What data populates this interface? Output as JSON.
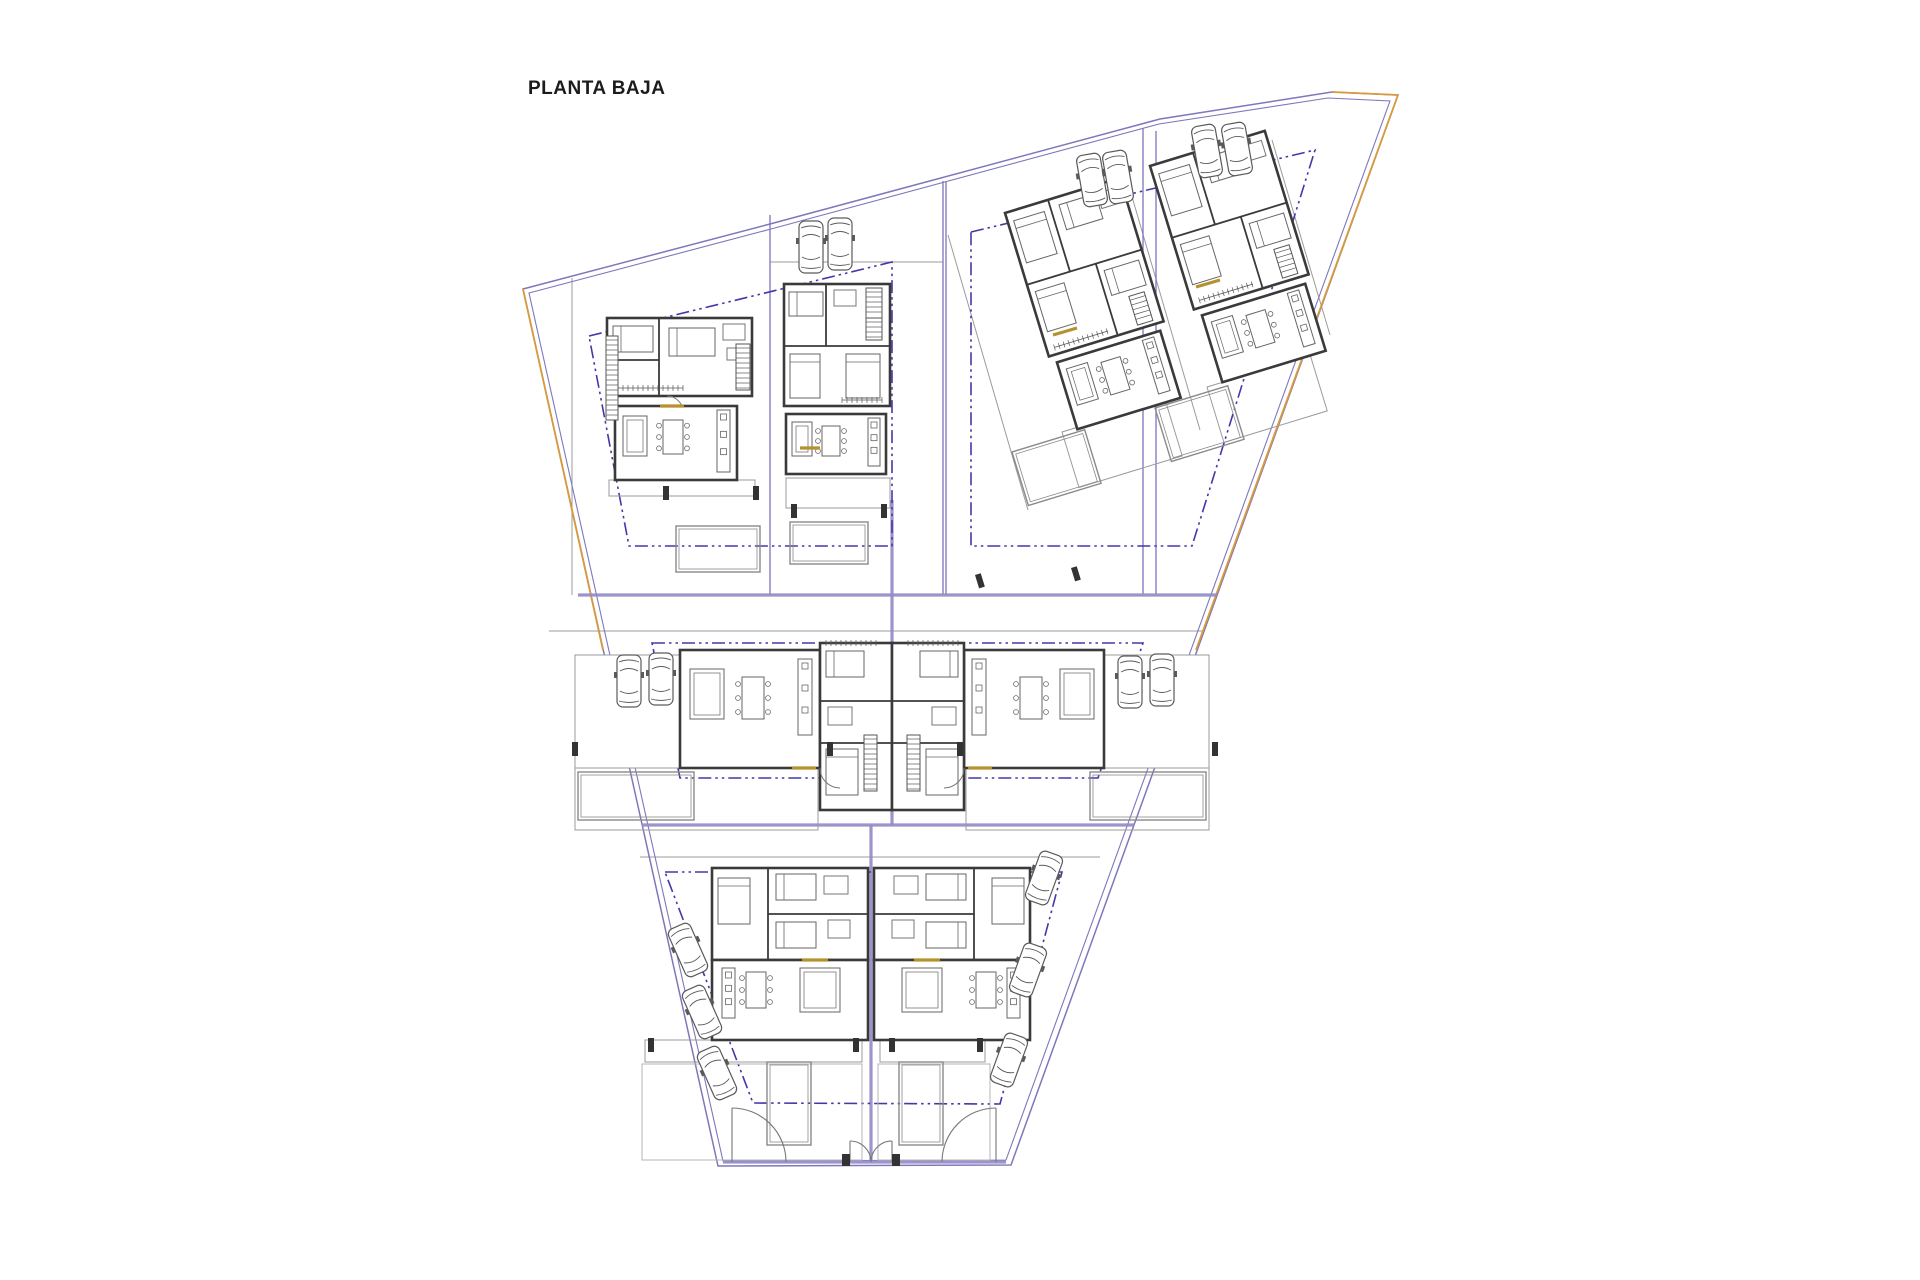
{
  "title": {
    "label": "PLANTA BAJA"
  },
  "colors": {
    "boundary_purple": "#7d77bc",
    "divider_lavender": "#918ac7",
    "setback_violet": "#4338a8",
    "site_orange": "#d79a3c",
    "wall_dark": "#3a3a3a",
    "furniture": "#666666",
    "thin_gray": "#9b9b9b",
    "garden_gray": "#b5b5b5",
    "gold_accent": "#b5922f",
    "car_gray": "#5a5a5a",
    "post_dark": "#333333"
  },
  "canvas": {
    "w": 1920,
    "h": 1280
  },
  "site": {
    "outer": "523,289 770,224 1160,119 1332,92 1398,95 1011,1165 718,1166",
    "inner": "529,293 771,229 1159,124 1328,98 1390,101 1006,1160 723,1161",
    "orange_segments": [
      [
        [
          523,
          289
        ],
        [
          603,
          650
        ]
      ],
      [
        [
          1332,
          92
        ],
        [
          1398,
          95
        ]
      ],
      [
        [
          1398,
          95
        ],
        [
          1196,
          650
        ]
      ]
    ]
  },
  "dividers_thick": [
    [
      578,
      595,
      1217,
      595
    ],
    [
      642,
      825,
      1134,
      825
    ],
    [
      892,
      500,
      892,
      825
    ],
    [
      871,
      825,
      871,
      1161
    ],
    [
      723,
      1162,
      1006,
      1162
    ]
  ],
  "dividers_thin_purple": [
    [
      770,
      215,
      770,
      595
    ],
    [
      943,
      181,
      943,
      595
    ],
    [
      946,
      182,
      946,
      595
    ],
    [
      1143,
      128,
      1143,
      594
    ],
    [
      1156,
      131,
      1156,
      594
    ]
  ],
  "thin_lines": [
    [
      572,
      278,
      572,
      595
    ],
    [
      770,
      262,
      943,
      262
    ],
    [
      549,
      631,
      1203,
      631
    ],
    [
      640,
      857,
      1100,
      857
    ],
    [
      948,
      235,
      1028,
      510
    ],
    [
      1128,
      183,
      1200,
      430
    ],
    [
      1272,
      140,
      1330,
      335
    ]
  ],
  "setbacks": [
    "589,336 892,262 892,546 629,546",
    "971,232 1315,150 1192,546 971,546",
    "652,643 1143,643 1098,778 680,778",
    "665,872 1062,872 1000,1104 753,1103"
  ],
  "terraces": [
    {
      "x": 609,
      "y": 480,
      "w": 146,
      "h": 16
    },
    {
      "x": 786,
      "y": 478,
      "w": 104,
      "h": 30
    },
    {
      "x": 575,
      "y": 768,
      "w": 243,
      "h": 62
    },
    {
      "x": 966,
      "y": 768,
      "w": 243,
      "h": 62
    },
    {
      "x": 645,
      "y": 1040,
      "w": 217,
      "h": 22
    },
    {
      "x": 880,
      "y": 1040,
      "w": 105,
      "h": 22
    },
    {
      "x": 1062,
      "y": 432,
      "w": 108,
      "h": 58,
      "rot": -17
    },
    {
      "x": 1207,
      "y": 387,
      "w": 108,
      "h": 58,
      "rot": -17
    }
  ],
  "pools": [
    {
      "x": 676,
      "y": 526,
      "w": 84,
      "h": 46
    },
    {
      "x": 790,
      "y": 522,
      "w": 78,
      "h": 42
    },
    {
      "x": 1012,
      "y": 452,
      "w": 76,
      "h": 56,
      "rot": -17
    },
    {
      "x": 1155,
      "y": 408,
      "w": 76,
      "h": 56,
      "rot": -17
    },
    {
      "x": 578,
      "y": 772,
      "w": 116,
      "h": 48
    },
    {
      "x": 1090,
      "y": 772,
      "w": 116,
      "h": 48
    },
    {
      "x": 767,
      "y": 1062,
      "w": 44,
      "h": 83
    },
    {
      "x": 899,
      "y": 1062,
      "w": 44,
      "h": 83
    }
  ],
  "gardens": [
    {
      "x": 642,
      "y": 1064,
      "w": 220,
      "h": 96
    },
    {
      "x": 878,
      "y": 1064,
      "w": 112,
      "h": 96
    }
  ],
  "templates": {
    "villa1": [
      {
        "t": "wall",
        "x": 0,
        "y": 0,
        "w": 145,
        "h": 78
      },
      {
        "t": "line",
        "x1": 52,
        "y1": 0,
        "x2": 52,
        "y2": 78
      },
      {
        "t": "line",
        "x1": 0,
        "y1": 42,
        "x2": 52,
        "y2": 42
      },
      {
        "t": "bedh",
        "x": 6,
        "y": 8,
        "w": 40,
        "h": 26
      },
      {
        "t": "bedh",
        "x": 62,
        "y": 10,
        "w": 46,
        "h": 28
      },
      {
        "t": "box",
        "x": 116,
        "y": 6,
        "w": 22,
        "h": 16
      },
      {
        "t": "box",
        "x": 120,
        "y": 30,
        "w": 12,
        "h": 12
      },
      {
        "t": "stair",
        "x": 129,
        "y": 26,
        "w": 14,
        "h": 46,
        "dir": "v"
      },
      {
        "t": "comb",
        "x": 6,
        "y": 70,
        "w": 70,
        "dir": "h"
      },
      {
        "t": "arc",
        "d": "M 60,78 a 16,16 0 0 1 16,16"
      },
      {
        "t": "wall",
        "x": 8,
        "y": 88,
        "w": 122,
        "h": 74
      },
      {
        "t": "sofa",
        "x": 16,
        "y": 98,
        "w": 24,
        "h": 40
      },
      {
        "t": "table",
        "x": 56,
        "y": 102,
        "w": 20,
        "h": 34
      },
      {
        "t": "kitchen",
        "x": 110,
        "y": 92,
        "w": 13,
        "h": 62
      }
    ],
    "villa2": [
      {
        "t": "wall",
        "x": 0,
        "y": 0,
        "w": 106,
        "h": 122
      },
      {
        "t": "line",
        "x1": 0,
        "y1": 62,
        "x2": 106,
        "y2": 62
      },
      {
        "t": "line",
        "x1": 42,
        "y1": 0,
        "x2": 42,
        "y2": 62
      },
      {
        "t": "bedh",
        "x": 5,
        "y": 8,
        "w": 34,
        "h": 24
      },
      {
        "t": "box",
        "x": 50,
        "y": 6,
        "w": 22,
        "h": 16
      },
      {
        "t": "bed",
        "x": 6,
        "y": 70,
        "w": 30,
        "h": 44
      },
      {
        "t": "bed",
        "x": 62,
        "y": 70,
        "w": 34,
        "h": 44
      },
      {
        "t": "stair",
        "x": 82,
        "y": 14,
        "w": 16,
        "h": 42,
        "dir": "v"
      },
      {
        "t": "comb",
        "x": 58,
        "y": 116,
        "w": 40,
        "dir": "h"
      },
      {
        "t": "wall",
        "x": 2,
        "y": 130,
        "w": 100,
        "h": 60
      },
      {
        "t": "sofa",
        "x": 8,
        "y": 138,
        "w": 20,
        "h": 34
      },
      {
        "t": "table",
        "x": 38,
        "y": 142,
        "w": 18,
        "h": 30
      },
      {
        "t": "kitchen",
        "x": 84,
        "y": 134,
        "w": 12,
        "h": 48
      }
    ],
    "villa3": [
      {
        "t": "wall",
        "x": 0,
        "y": 0,
        "w": 120,
        "h": 150
      },
      {
        "t": "line",
        "x1": 0,
        "y1": 75,
        "x2": 120,
        "y2": 75
      },
      {
        "t": "line",
        "x1": 45,
        "y1": 0,
        "x2": 45,
        "y2": 75
      },
      {
        "t": "line",
        "x1": 72,
        "y1": 75,
        "x2": 72,
        "y2": 150
      },
      {
        "t": "bed",
        "x": 6,
        "y": 10,
        "w": 32,
        "h": 44
      },
      {
        "t": "bedh",
        "x": 54,
        "y": 8,
        "w": 38,
        "h": 26
      },
      {
        "t": "box",
        "x": 94,
        "y": 8,
        "w": 20,
        "h": 16
      },
      {
        "t": "bed",
        "x": 6,
        "y": 84,
        "w": 30,
        "h": 42
      },
      {
        "t": "bedh",
        "x": 78,
        "y": 84,
        "w": 36,
        "h": 26
      },
      {
        "t": "stair",
        "x": 94,
        "y": 116,
        "w": 16,
        "h": 30,
        "dir": "v"
      },
      {
        "t": "comb",
        "x": 8,
        "y": 143,
        "w": 56,
        "dir": "h"
      },
      {
        "t": "wall",
        "x": 6,
        "y": 158,
        "w": 108,
        "h": 70
      },
      {
        "t": "sofa",
        "x": 13,
        "y": 167,
        "w": 22,
        "h": 38
      },
      {
        "t": "table",
        "x": 48,
        "y": 171,
        "w": 20,
        "h": 34
      },
      {
        "t": "kitchen",
        "x": 94,
        "y": 162,
        "w": 12,
        "h": 56
      }
    ],
    "wide": [
      {
        "t": "rect",
        "x": 0,
        "y": 12,
        "w": 105,
        "h": 113
      },
      {
        "t": "wall",
        "x": 105,
        "y": 7,
        "w": 140,
        "h": 118
      },
      {
        "t": "sofa",
        "x": 115,
        "y": 26,
        "w": 34,
        "h": 50
      },
      {
        "t": "table",
        "x": 167,
        "y": 34,
        "w": 22,
        "h": 42
      },
      {
        "t": "kitchen",
        "x": 223,
        "y": 16,
        "w": 14,
        "h": 76
      },
      {
        "t": "wall",
        "x": 245,
        "y": 0,
        "w": 72,
        "h": 167
      },
      {
        "t": "line",
        "x1": 245,
        "y1": 58,
        "x2": 317,
        "y2": 58
      },
      {
        "t": "line",
        "x1": 245,
        "y1": 100,
        "x2": 317,
        "y2": 100
      },
      {
        "t": "bedh",
        "x": 251,
        "y": 8,
        "w": 38,
        "h": 26
      },
      {
        "t": "box",
        "x": 253,
        "y": 64,
        "w": 24,
        "h": 18
      },
      {
        "t": "bed",
        "x": 251,
        "y": 106,
        "w": 32,
        "h": 46
      },
      {
        "t": "stair",
        "x": 289,
        "y": 92,
        "w": 13,
        "h": 56,
        "dir": "v"
      },
      {
        "t": "comb",
        "x": 251,
        "y": 0,
        "w": 50,
        "dir": "h"
      },
      {
        "t": "gold",
        "x1": 217,
        "y1": 125,
        "x2": 241,
        "y2": 125
      },
      {
        "t": "arc",
        "d": "M 245,125 a 20,20 0 0 0 20,20"
      }
    ],
    "tall": [
      {
        "t": "stair",
        "x": 8,
        "y": 4,
        "w": 48,
        "h": 14,
        "dir": "h"
      },
      {
        "t": "wall",
        "x": 0,
        "y": 0,
        "w": 156,
        "h": 92
      },
      {
        "t": "line",
        "x1": 56,
        "y1": 0,
        "x2": 56,
        "y2": 92
      },
      {
        "t": "line",
        "x1": 56,
        "y1": 46,
        "x2": 156,
        "y2": 46
      },
      {
        "t": "bed",
        "x": 6,
        "y": 10,
        "w": 32,
        "h": 46
      },
      {
        "t": "bedh",
        "x": 64,
        "y": 6,
        "w": 40,
        "h": 26
      },
      {
        "t": "box",
        "x": 112,
        "y": 8,
        "w": 24,
        "h": 18
      },
      {
        "t": "bedh",
        "x": 64,
        "y": 54,
        "w": 40,
        "h": 26
      },
      {
        "t": "box",
        "x": 116,
        "y": 52,
        "w": 22,
        "h": 18
      },
      {
        "t": "wall",
        "x": 0,
        "y": 92,
        "w": 156,
        "h": 80
      },
      {
        "t": "kitchen",
        "x": 10,
        "y": 100,
        "w": 13,
        "h": 50
      },
      {
        "t": "table",
        "x": 34,
        "y": 104,
        "w": 20,
        "h": 36
      },
      {
        "t": "sofa",
        "x": 88,
        "y": 100,
        "w": 40,
        "h": 44
      },
      {
        "t": "gold",
        "x1": 90,
        "y1": 92,
        "x2": 116,
        "y2": 92
      }
    ]
  },
  "houses": [
    {
      "name": "house-1",
      "template": "villa1",
      "transform": "translate(607,318)"
    },
    {
      "name": "house-2",
      "template": "villa2",
      "transform": "translate(784,284)"
    },
    {
      "name": "house-3",
      "template": "villa3",
      "transform": "translate(1005,213) rotate(-17)"
    },
    {
      "name": "house-4",
      "template": "villa3",
      "transform": "translate(1150,166) rotate(-17)"
    },
    {
      "name": "house-5",
      "template": "wide",
      "transform": "translate(575,643)"
    },
    {
      "name": "house-6",
      "template": "wide",
      "transform": "translate(1209,643) scale(-1,1)"
    },
    {
      "name": "house-7",
      "template": "tall",
      "transform": "translate(712,868)"
    },
    {
      "name": "house-8",
      "template": "tall",
      "transform": "translate(1030,868) scale(-1,1)"
    }
  ],
  "stairs": [
    {
      "x": 606,
      "y": 336,
      "w": 12,
      "h": 84,
      "dir": "v"
    },
    {
      "x": 866,
      "y": 288,
      "w": 16,
      "h": 30,
      "dir": "v"
    }
  ],
  "posts": [
    {
      "x": 663,
      "y": 486
    },
    {
      "x": 753,
      "y": 486
    },
    {
      "x": 791,
      "y": 504
    },
    {
      "x": 881,
      "y": 504
    },
    {
      "x": 975,
      "y": 575,
      "rot": -17
    },
    {
      "x": 1071,
      "y": 568,
      "rot": -17
    },
    {
      "x": 572,
      "y": 742
    },
    {
      "x": 827,
      "y": 742
    },
    {
      "x": 957,
      "y": 742
    },
    {
      "x": 1212,
      "y": 742
    },
    {
      "x": 648,
      "y": 1038
    },
    {
      "x": 853,
      "y": 1038
    },
    {
      "x": 889,
      "y": 1038
    },
    {
      "x": 977,
      "y": 1038
    }
  ],
  "gold_marks": [
    [
      660,
      406,
      684,
      406
    ],
    [
      800,
      448,
      820,
      448
    ],
    [
      1053,
      335,
      1077,
      328
    ],
    [
      1196,
      287,
      1220,
      280
    ]
  ],
  "gates": {
    "arcs": [
      "M 732,1108 A 54,54 0 0 1 786,1162",
      "M 996,1108 A 54,54 0 0 0 942,1162",
      "M 850,1141 A 21,21 0 0 1 871,1162",
      "M 892,1141 A 21,21 0 0 0 871,1162"
    ],
    "leaves": [
      [
        732,
        1162,
        732,
        1108
      ],
      [
        996,
        1162,
        996,
        1108
      ],
      [
        850,
        1162,
        850,
        1141
      ],
      [
        892,
        1162,
        892,
        1141
      ]
    ],
    "posts": [
      {
        "x": 842,
        "y": 1154,
        "w": 8,
        "h": 12
      },
      {
        "x": 892,
        "y": 1154,
        "w": 8,
        "h": 12
      }
    ]
  },
  "cars": [
    {
      "x": 811,
      "y": 247,
      "rot": 0
    },
    {
      "x": 840,
      "y": 244,
      "rot": 0
    },
    {
      "x": 1092,
      "y": 180,
      "rot": -10
    },
    {
      "x": 1118,
      "y": 177,
      "rot": -10
    },
    {
      "x": 1207,
      "y": 151,
      "rot": -10
    },
    {
      "x": 1237,
      "y": 149,
      "rot": -10
    },
    {
      "x": 629,
      "y": 681,
      "rot": 0
    },
    {
      "x": 661,
      "y": 679,
      "rot": 0
    },
    {
      "x": 1130,
      "y": 682,
      "rot": 0
    },
    {
      "x": 1162,
      "y": 680,
      "rot": 0
    },
    {
      "x": 688,
      "y": 950,
      "rot": -24
    },
    {
      "x": 702,
      "y": 1012,
      "rot": -24
    },
    {
      "x": 717,
      "y": 1073,
      "rot": -24
    },
    {
      "x": 1044,
      "y": 878,
      "rot": 20
    },
    {
      "x": 1028,
      "y": 970,
      "rot": 20
    },
    {
      "x": 1009,
      "y": 1060,
      "rot": 20
    }
  ]
}
